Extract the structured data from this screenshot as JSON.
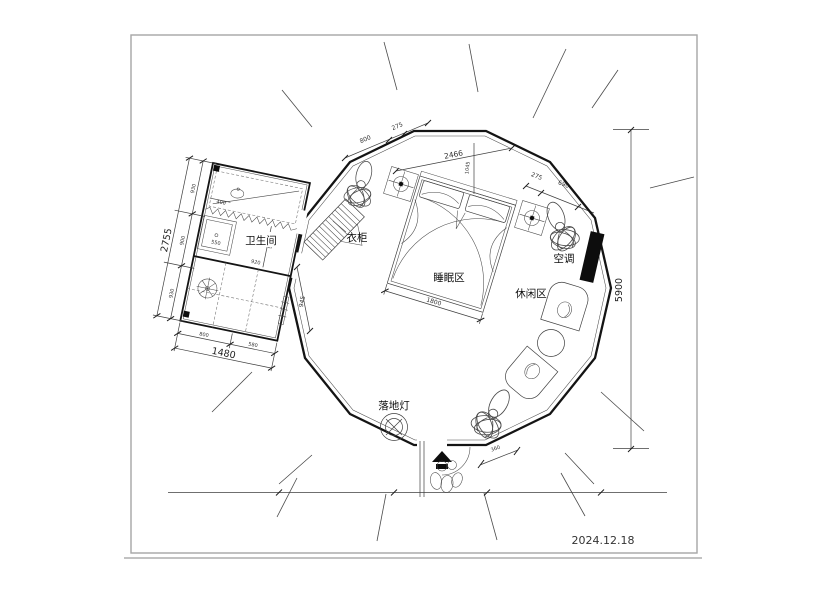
{
  "title_block": {
    "date": "2024.12.18"
  },
  "rooms": {
    "bathroom": "卫生间",
    "wardrobe": "衣柜",
    "sleeping_area": "睡眠区",
    "leisure_area": "休闲区",
    "air_conditioner": "空调",
    "floor_lamp": "落地灯"
  },
  "dimensions": {
    "overall_height": "5900",
    "top_width": "2466",
    "top_offset": "1045",
    "top_left_edge": [
      "800",
      "275"
    ],
    "top_right_edge": [
      "275",
      "690"
    ],
    "bed_width": "1800",
    "entrance_width": "360",
    "bathroom": {
      "total_height": "2755",
      "height_segments": [
        "930",
        "900",
        "930"
      ],
      "total_width": "1480",
      "width_segments": [
        "800",
        "580"
      ],
      "side": "945",
      "counter": "400",
      "shower": "550",
      "inner_height": "900",
      "inner_width": "920"
    }
  }
}
